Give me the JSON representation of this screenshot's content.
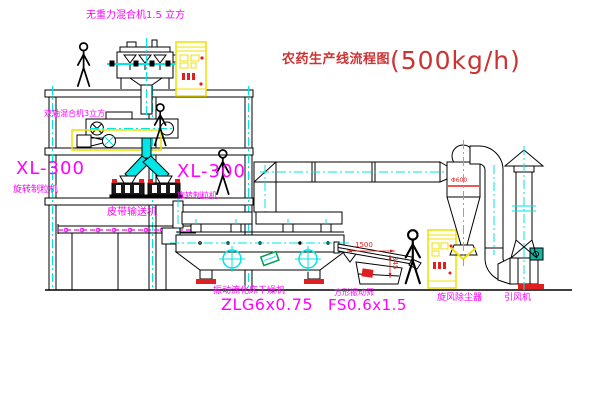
{
  "title": {
    "name": "农药生产线流程图",
    "capacity": "(500kg/h)"
  },
  "labels": {
    "gravity_free_mixer": "无重力混合机1.5 立方",
    "twin_shaft_mixer": "双轴混合机3立方",
    "granulator_left_model": "XL-300",
    "granulator_left_name": "旋转制粒机",
    "granulator_mid_model": "XL-300",
    "granulator_mid_name": "旋转制粒机",
    "belt_conveyor": "皮带输送机",
    "fluid_bed_dryer_name": "振动流化床干燥机",
    "fluid_bed_dryer_model": "ZLG6x0.75",
    "vibrating_screen_name": "方形振动筛",
    "vibrating_screen_model": "FS0.6x1.5",
    "cyclone": "旋风除尘器",
    "induced_draft_fan": "引风机"
  },
  "dimensions": {
    "screen_length": "1500",
    "screen_height": "345",
    "cyclone_diameter": "Φ600"
  },
  "colors": {
    "label_magenta": "#ff00ff",
    "title_red": "#cc3333",
    "dimension_red": "#e02020",
    "centerline_cyan": "#00e5e5",
    "cabinet_yellow": "#f0e000",
    "motor_green": "#16b3a0",
    "line_black": "#000000"
  }
}
